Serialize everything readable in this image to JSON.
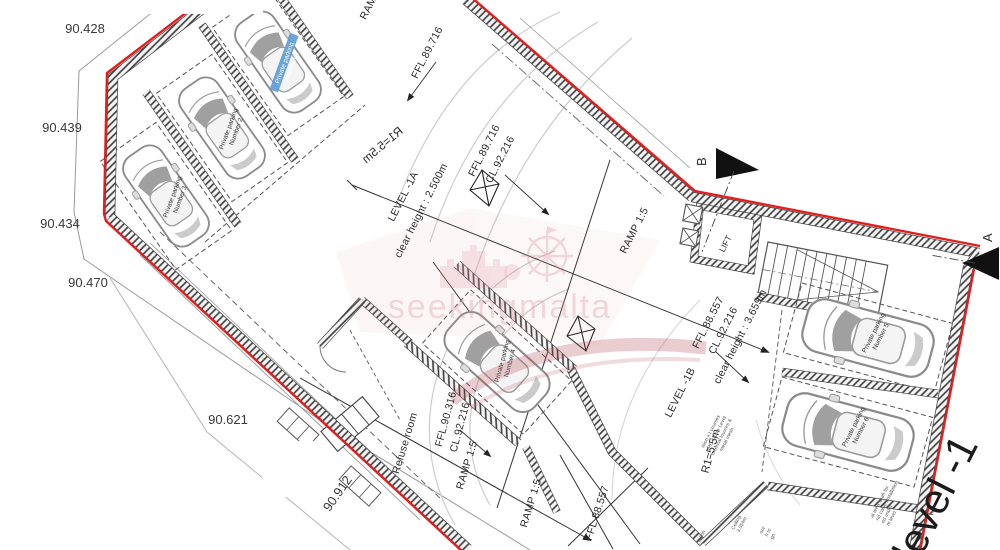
{
  "drawing": {
    "watermark_text": "seekingmalta",
    "level_title": "level -1",
    "spot_levels": [
      "90.428",
      "90.439",
      "90.434",
      "90.470",
      "90.621",
      "90.912"
    ],
    "area_1a": {
      "name": "LEVEL -1A",
      "clear_height": "clear height : 2.500m"
    },
    "area_1b": {
      "name": "LEVEL -1B",
      "clear_height": "clear height : 3.659m",
      "ffl": "FFL.88.557",
      "cl": "CL.92.216"
    },
    "levels": {
      "ffl_entry": "FFL.89.716",
      "cl_main": "CL.92.216",
      "ffl_mid": "FFL.90.316",
      "ffl_low": "FFL.88.557"
    },
    "ramp_label": "RAMP 1:5",
    "lift_label": "LIFT",
    "refuse_label": "Refuse room",
    "radius_label": "R1=5.5m",
    "section_markers": {
      "a": "A",
      "b": "B"
    },
    "parking_line1": "Private parking",
    "parking_spaces": [
      "Number 1",
      "Number 2",
      "Number 3",
      "Number 4",
      "Number 5",
      "Number 6"
    ],
    "notes_1b": [
      "ision x t courses",
      "HPD & Low Level",
      "external louvres &",
      "metal mesh"
    ],
    "notes_bottom": [
      "lation",
      "Ceiling",
      "3.054m",
      "oor",
      "h to",
      "gn"
    ],
    "notes_right": [
      "al area shaft for",
      "nd cable installation",
      "ed under",
      "nt level"
    ],
    "colors": {
      "boundary_red": "#e01f1f",
      "wall_dark": "#3c3c3c",
      "watermark_pink": "#d98a94"
    }
  }
}
